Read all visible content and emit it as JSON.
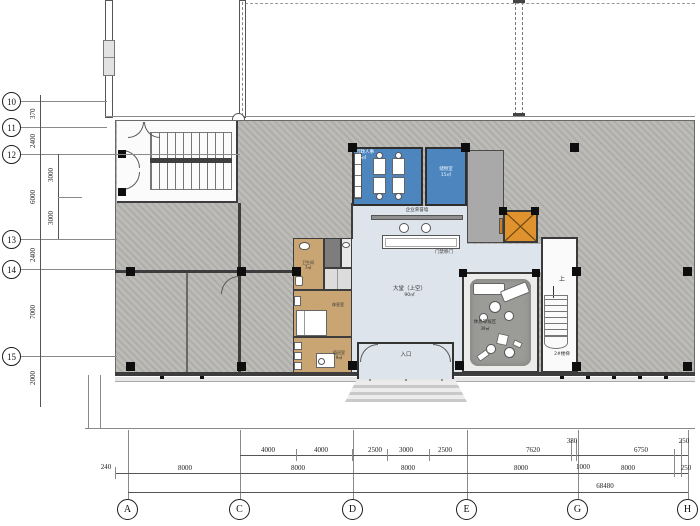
{
  "grid": {
    "rows": [
      "10",
      "11",
      "12",
      "13",
      "14",
      "15"
    ],
    "cols": [
      "A",
      "C",
      "D",
      "E",
      "G",
      "H"
    ]
  },
  "dims": {
    "left_outer": [
      "370",
      "2400",
      "6000",
      "2400",
      "7000",
      "2000"
    ],
    "left_inner": [
      "3000",
      "3000"
    ],
    "bottom_upper": [
      "4000",
      "4000",
      "2500",
      "3000",
      "2500",
      "7620",
      "380",
      "6750",
      "250"
    ],
    "bottom_lower": [
      "240",
      "8000",
      "8000",
      "8000",
      "8000",
      "1000",
      "8000",
      "250"
    ],
    "total": "68480"
  },
  "rooms": {
    "admin": {
      "name": "行政人事",
      "area": "16㎡"
    },
    "storage": {
      "name": "储物室",
      "area": "15㎡"
    },
    "honor_wall": {
      "name": "企业荣誉墙"
    },
    "access_door": {
      "name": "门禁移门"
    },
    "lobby": {
      "name": "大堂（上空）",
      "area": "90㎡"
    },
    "lounge": {
      "name": "休息等候区",
      "area": "39㎡"
    },
    "stair2": {
      "name": "2#楼梯"
    },
    "stair_up": {
      "name": "上"
    },
    "wc": {
      "name": "卫生间",
      "area": "7㎡"
    },
    "rest": {
      "name": "休息室"
    },
    "duty": {
      "name": "值班室",
      "area": "9㎡"
    },
    "entrance": {
      "name": "入口"
    }
  },
  "colors": {
    "blue_room": "#4d86bf",
    "tan_room": "#c8a572",
    "hall": "#dde4ec",
    "elevator": "#e0922f",
    "carpet": "#9b9b98",
    "dark_room": "#7d7d7d",
    "hatch_gray": "#b5b4b1"
  }
}
